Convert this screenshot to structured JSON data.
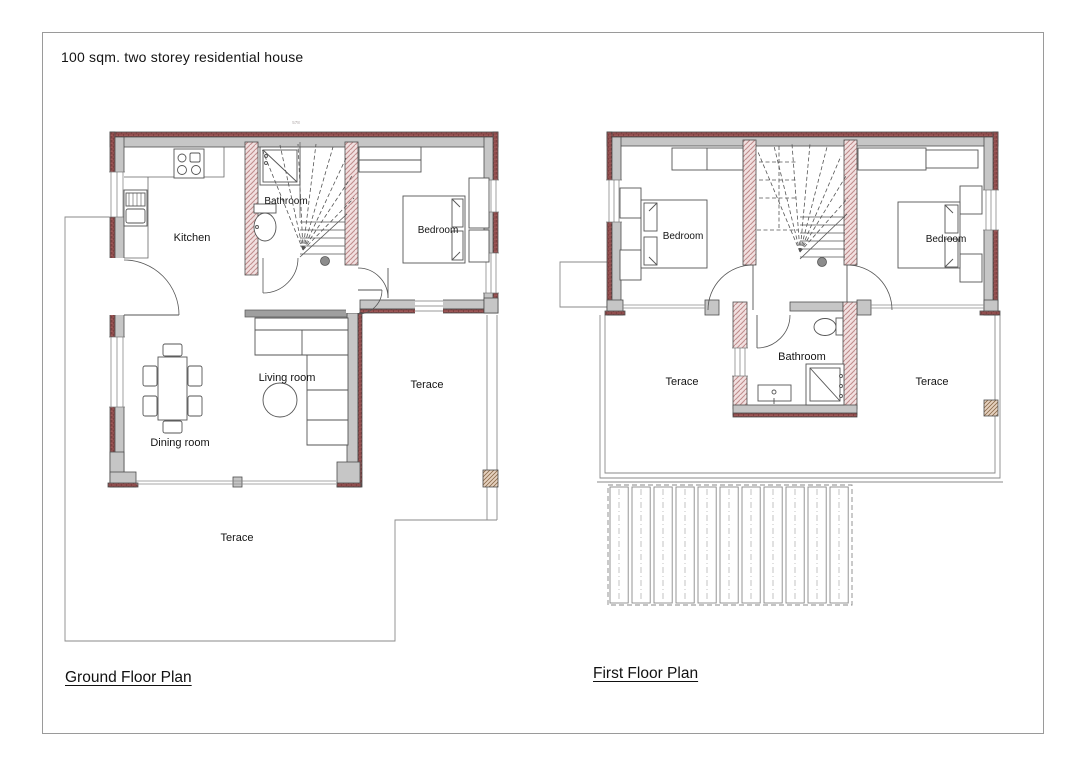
{
  "page": {
    "title": "100 sqm. two storey residential house"
  },
  "colors": {
    "exterior_wall_hatch": "#9d5656",
    "exterior_wall_hatch_dark": "#6b3333",
    "wall_fill": "#c6c6c6",
    "interior_wall_hatch": "#c18d8d",
    "interior_wall_bg": "#f1e0e0",
    "outline": "#4d4d4d",
    "thin_line": "#8a8a8a"
  },
  "ground_floor": {
    "label": "Ground Floor Plan",
    "dimension_note": "578",
    "rooms": {
      "kitchen": "Kitchen",
      "bathroom": "Bathroom",
      "bedroom": "Bedroom",
      "living_room": "Living room",
      "dining_room": "Dining room",
      "terrace_side": "Terace",
      "terrace_front": "Terace"
    }
  },
  "first_floor": {
    "label": "First Floor Plan",
    "rooms": {
      "bedroom_left": "Bedroom",
      "bedroom_right": "Bedroom",
      "bathroom": "Bathroom",
      "terrace_left": "Terace",
      "terrace_right": "Terace"
    }
  }
}
